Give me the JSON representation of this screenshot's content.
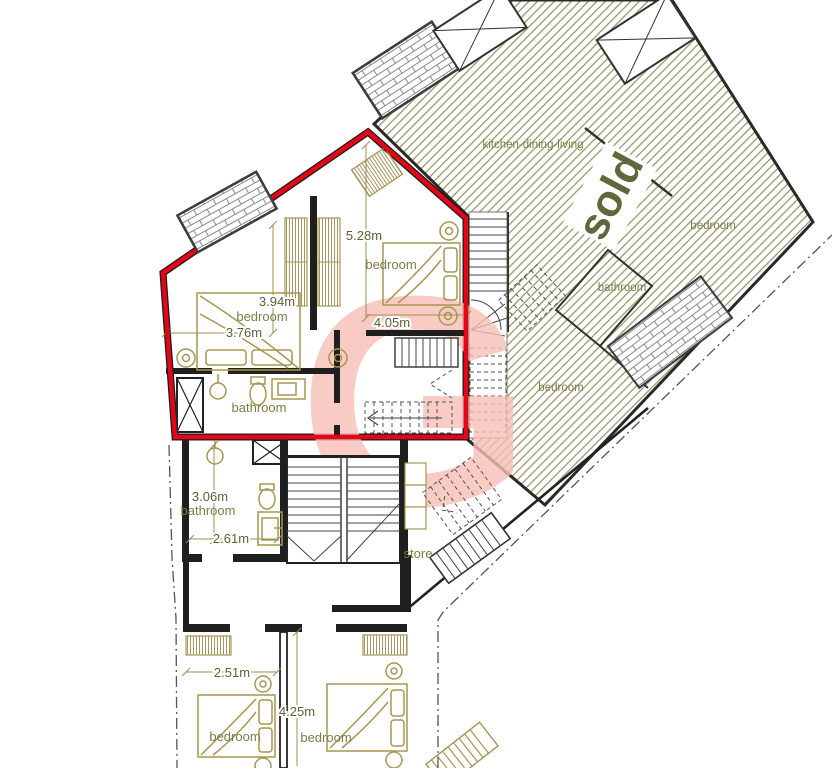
{
  "plan_title": "first-floor apartment plan",
  "watermark": {
    "letter": "G"
  },
  "sold_overlay": {
    "label": "sold"
  },
  "labels": {
    "kitchen_dining_living": "kitchen-dining-living",
    "bedroom": "bedroom",
    "bathroom": "bathroom",
    "store": "store"
  },
  "dimensions": {
    "right_bedroom_depth": "5.28m",
    "right_bedroom_width": "4.05m",
    "left_bedroom_depth": "3.94m",
    "left_bedroom_width": "3.76m",
    "lower_bathroom_depth": "3.06m",
    "lower_bathroom_width": "2.61m",
    "bottom_left_bedroom_width": "2.51m",
    "bottom_right_bedroom_depth": "4.25m"
  },
  "colors": {
    "highlight_red": "#e30617",
    "hatch_olive": "#8f9060",
    "label_olive": "#7b7e49",
    "dim_olive": "#5e6135",
    "furniture_tan": "#a8954f",
    "wall_black": "#1f1f1f",
    "watermark_pink": "#f7c0b6",
    "sold_text_olive": "#62673a"
  }
}
